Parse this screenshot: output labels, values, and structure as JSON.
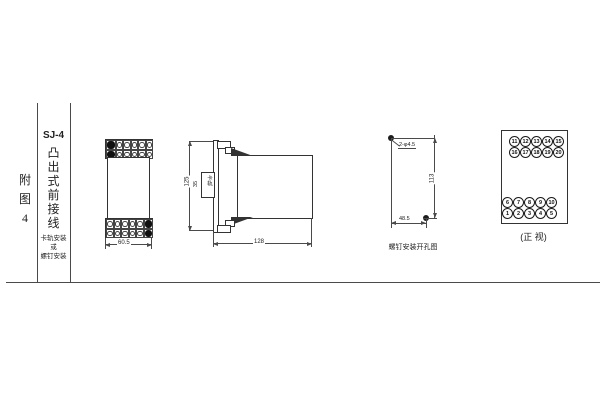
{
  "sidebar": {
    "figure_label": [
      "附",
      "图",
      "4"
    ],
    "model": "SJ-4",
    "type_chars": [
      "凸",
      "出",
      "式",
      "前",
      "接",
      "线"
    ],
    "mount_lines": [
      "卡轨安装",
      "或",
      "螺钉安装"
    ]
  },
  "front_view": {
    "width_dim": "60.5"
  },
  "side_view": {
    "height_dim": "125",
    "depth_dim": "128",
    "rail_width_dim": "35",
    "rail_label": "卡轨"
  },
  "drill_view": {
    "holes_label": "2-φ4.5",
    "height_dim": "113",
    "width_dim": "48.5",
    "caption": "螺钉安装开孔图"
  },
  "terminal_view": {
    "caption": "(正 视)",
    "rows": {
      "r11_15": [
        "11",
        "12",
        "13",
        "14",
        "15"
      ],
      "r16_20": [
        "16",
        "17",
        "18",
        "19",
        "20"
      ],
      "r6_10": [
        "6",
        "7",
        "8",
        "9",
        "10"
      ],
      "r1_5": [
        "1",
        "2",
        "3",
        "4",
        "5"
      ]
    }
  }
}
